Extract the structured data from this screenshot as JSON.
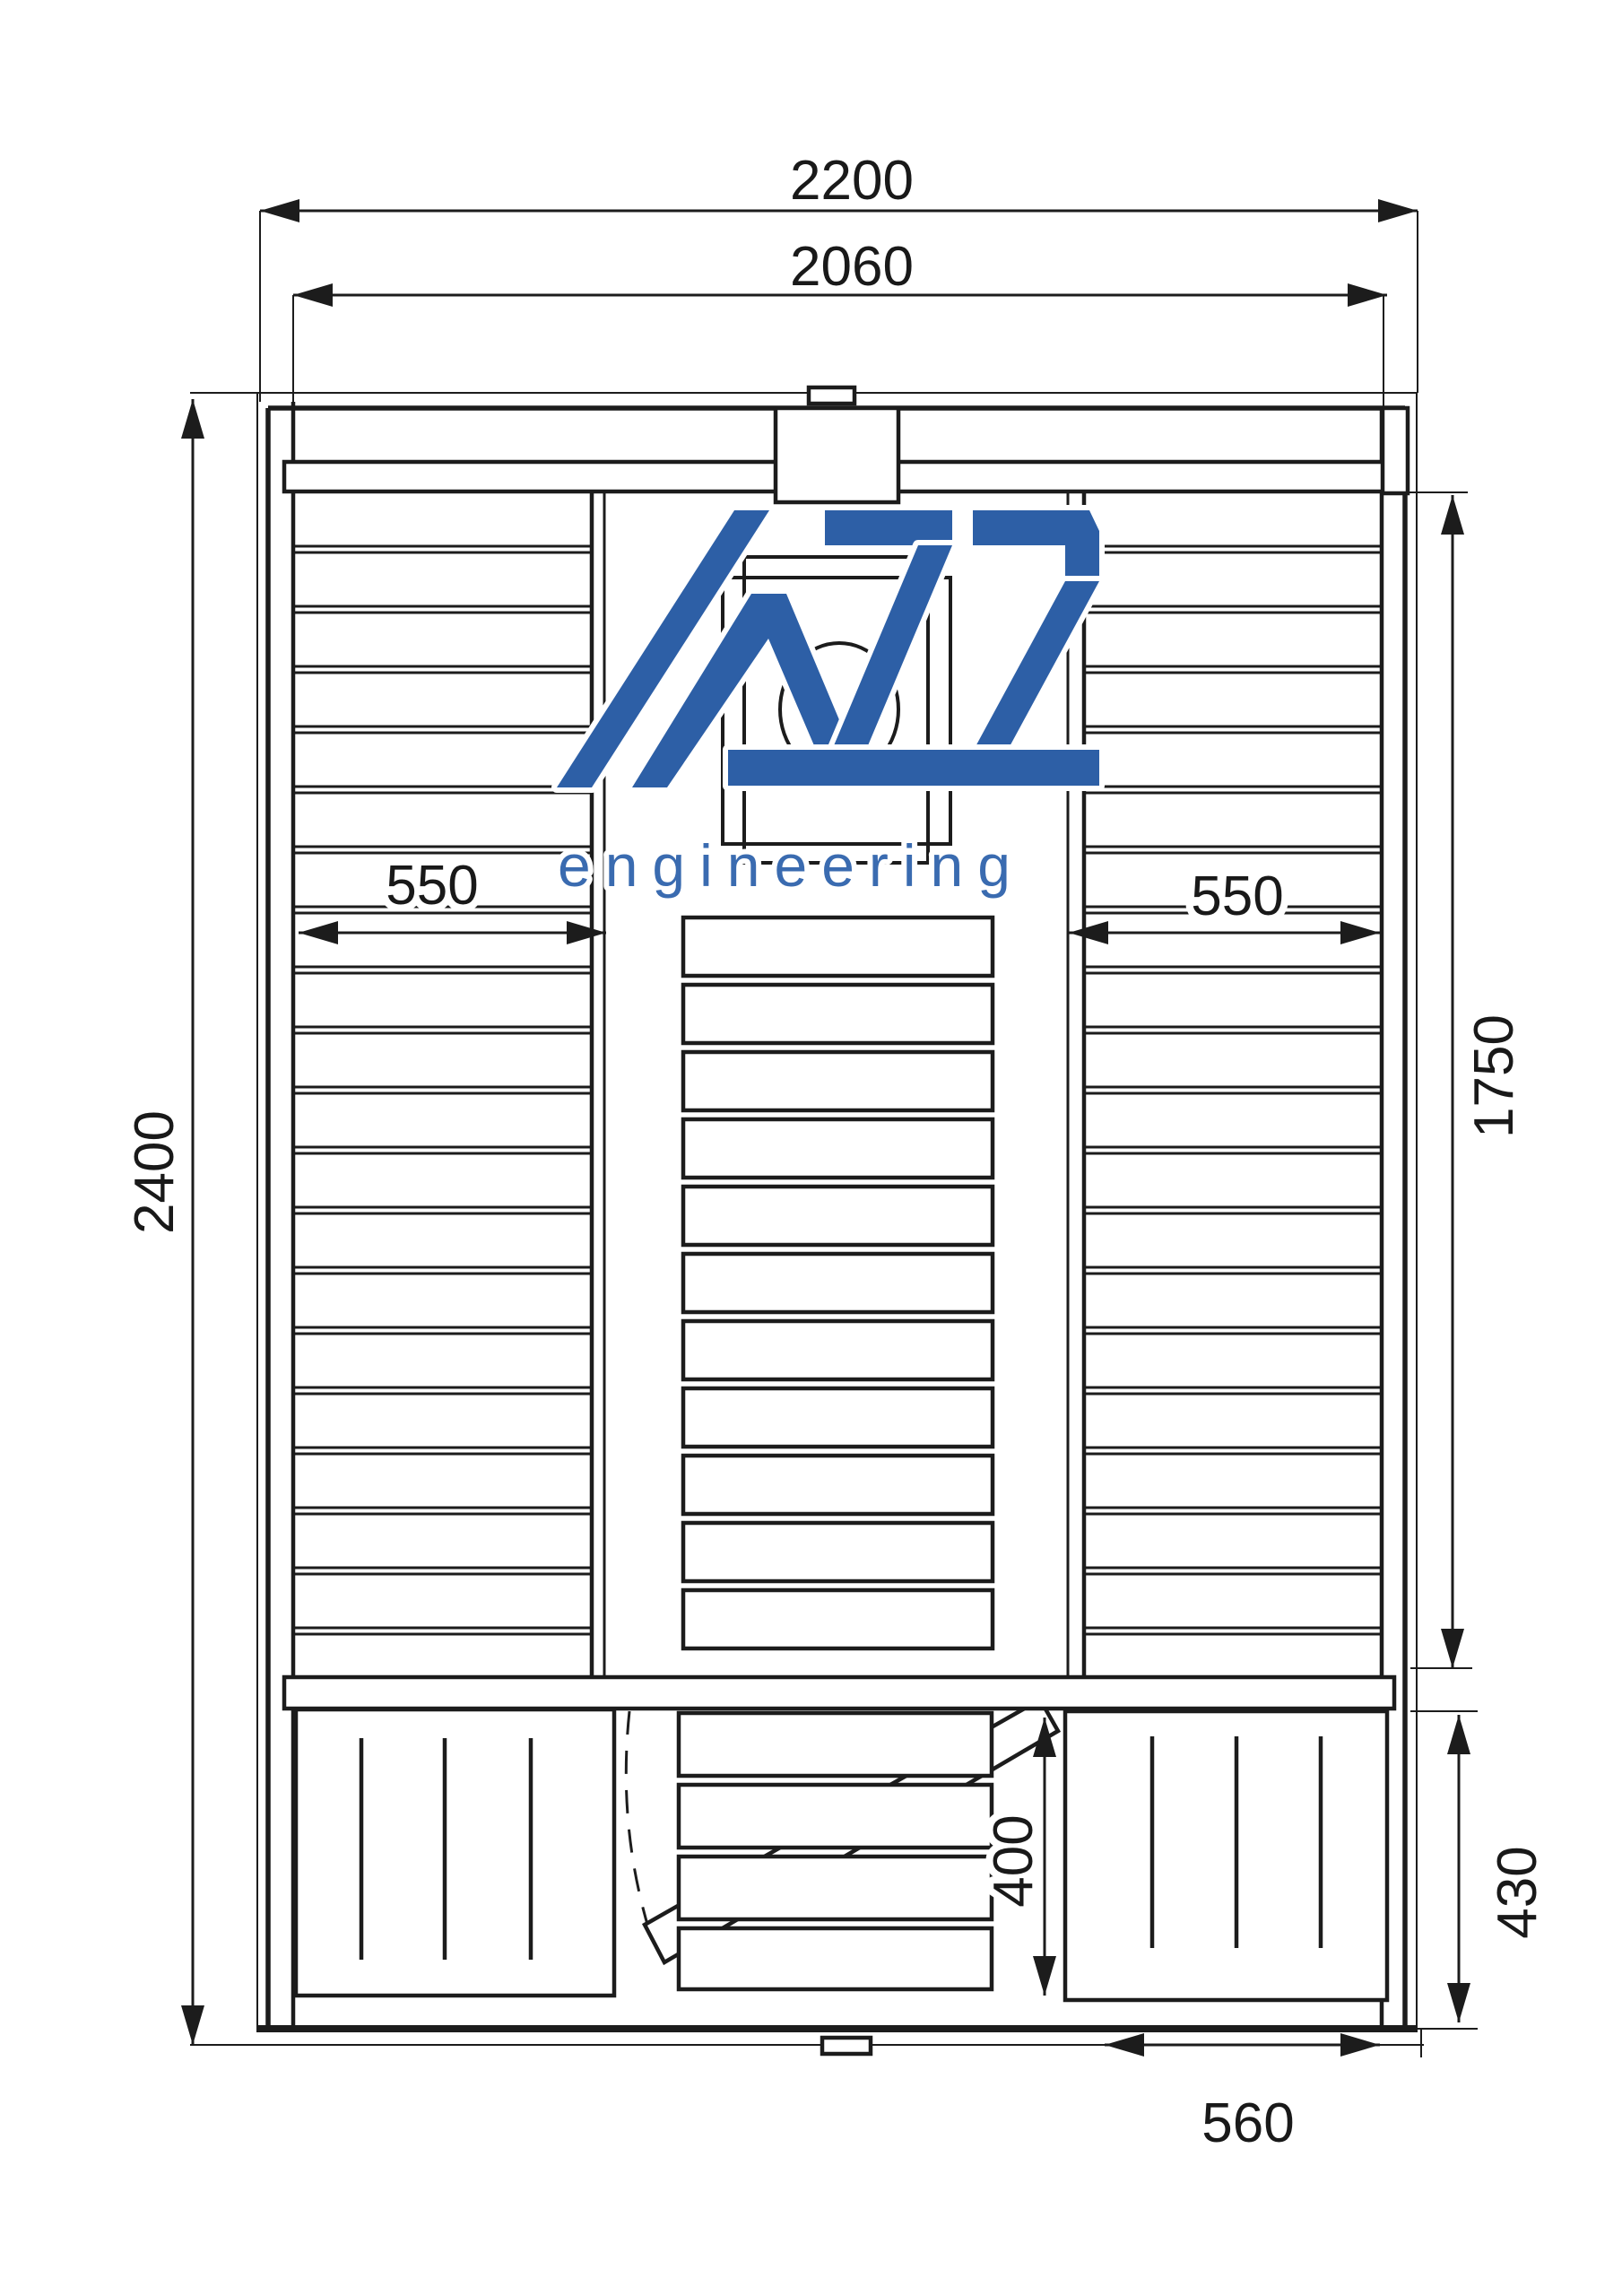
{
  "logo": {
    "acronym": "AZS",
    "subtitle": "engineering",
    "color": "#2d5fa6"
  },
  "dimensions": {
    "outer_width": "2200",
    "inner_width": "2060",
    "total_depth": "2400",
    "left_bench_width": "550",
    "right_bench_width": "550",
    "right_side_length": "1750",
    "door_area_width": "400",
    "front_right_depth": "430",
    "front_right_width": "560"
  }
}
